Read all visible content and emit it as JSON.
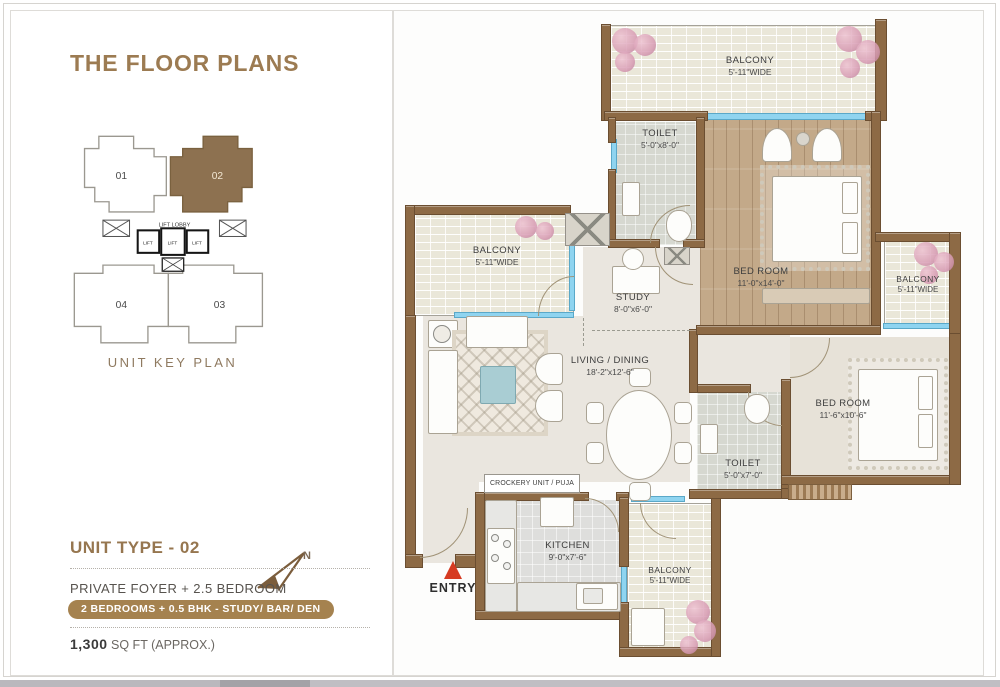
{
  "page": {
    "title": "THE FLOOR PLANS"
  },
  "key_plan": {
    "caption": "UNIT KEY PLAN",
    "unit_01": "01",
    "unit_02": "02",
    "unit_03": "03",
    "unit_04": "04",
    "lift_lobby_label": "LIFT LOBBY",
    "lift_label": "LIFT"
  },
  "unit_info": {
    "title": "UNIT TYPE - 02",
    "subtitle": "PRIVATE FOYER + 2.5 BEDROOM",
    "badge": "2 BEDROOMS + 0.5 BHK - STUDY/ BAR/ DEN",
    "area_value": "1,300",
    "area_suffix": " SQ FT (APPROX.)",
    "north_label": "N"
  },
  "plan": {
    "entry_label": "ENTRY",
    "rooms": {
      "balcony_top": {
        "name": "BALCONY",
        "dim": "5'-11\"WIDE"
      },
      "toilet_1": {
        "name": "TOILET",
        "dim": "5'-0\"x8'-0\""
      },
      "bed_room_1": {
        "name": "BED ROOM",
        "dim": "11'-0\"x14'-0\""
      },
      "balcony_left": {
        "name": "BALCONY",
        "dim": "5'-11\"WIDE"
      },
      "study": {
        "name": "STUDY",
        "dim": "8'-0\"x6'-0\""
      },
      "living_dining": {
        "name": "LIVING / DINING",
        "dim": "18'-2\"x12'-6\""
      },
      "bed_room_2": {
        "name": "BED ROOM",
        "dim": "11'-6\"x10'-6\""
      },
      "balcony_right": {
        "name": "BALCONY",
        "dim": "5'-11\"WIDE"
      },
      "toilet_2": {
        "name": "TOILET",
        "dim": "5'-0\"x7'-0\""
      },
      "kitchen": {
        "name": "KITCHEN",
        "dim": "9'-0\"x7'-6\""
      },
      "balcony_bottom": {
        "name": "BALCONY",
        "dim": "5'-11\"WIDE"
      },
      "crockery_label": "CROCKERY UNIT / PUJA"
    }
  },
  "colors": {
    "accent_brown": "#9c7b52",
    "badge_brown": "#a5824f",
    "wall_brown": "#8d6a45",
    "entry_red": "#d63b22",
    "window_blue": "#8fd4f0",
    "highlight_unit_fill": "#8d7150"
  }
}
